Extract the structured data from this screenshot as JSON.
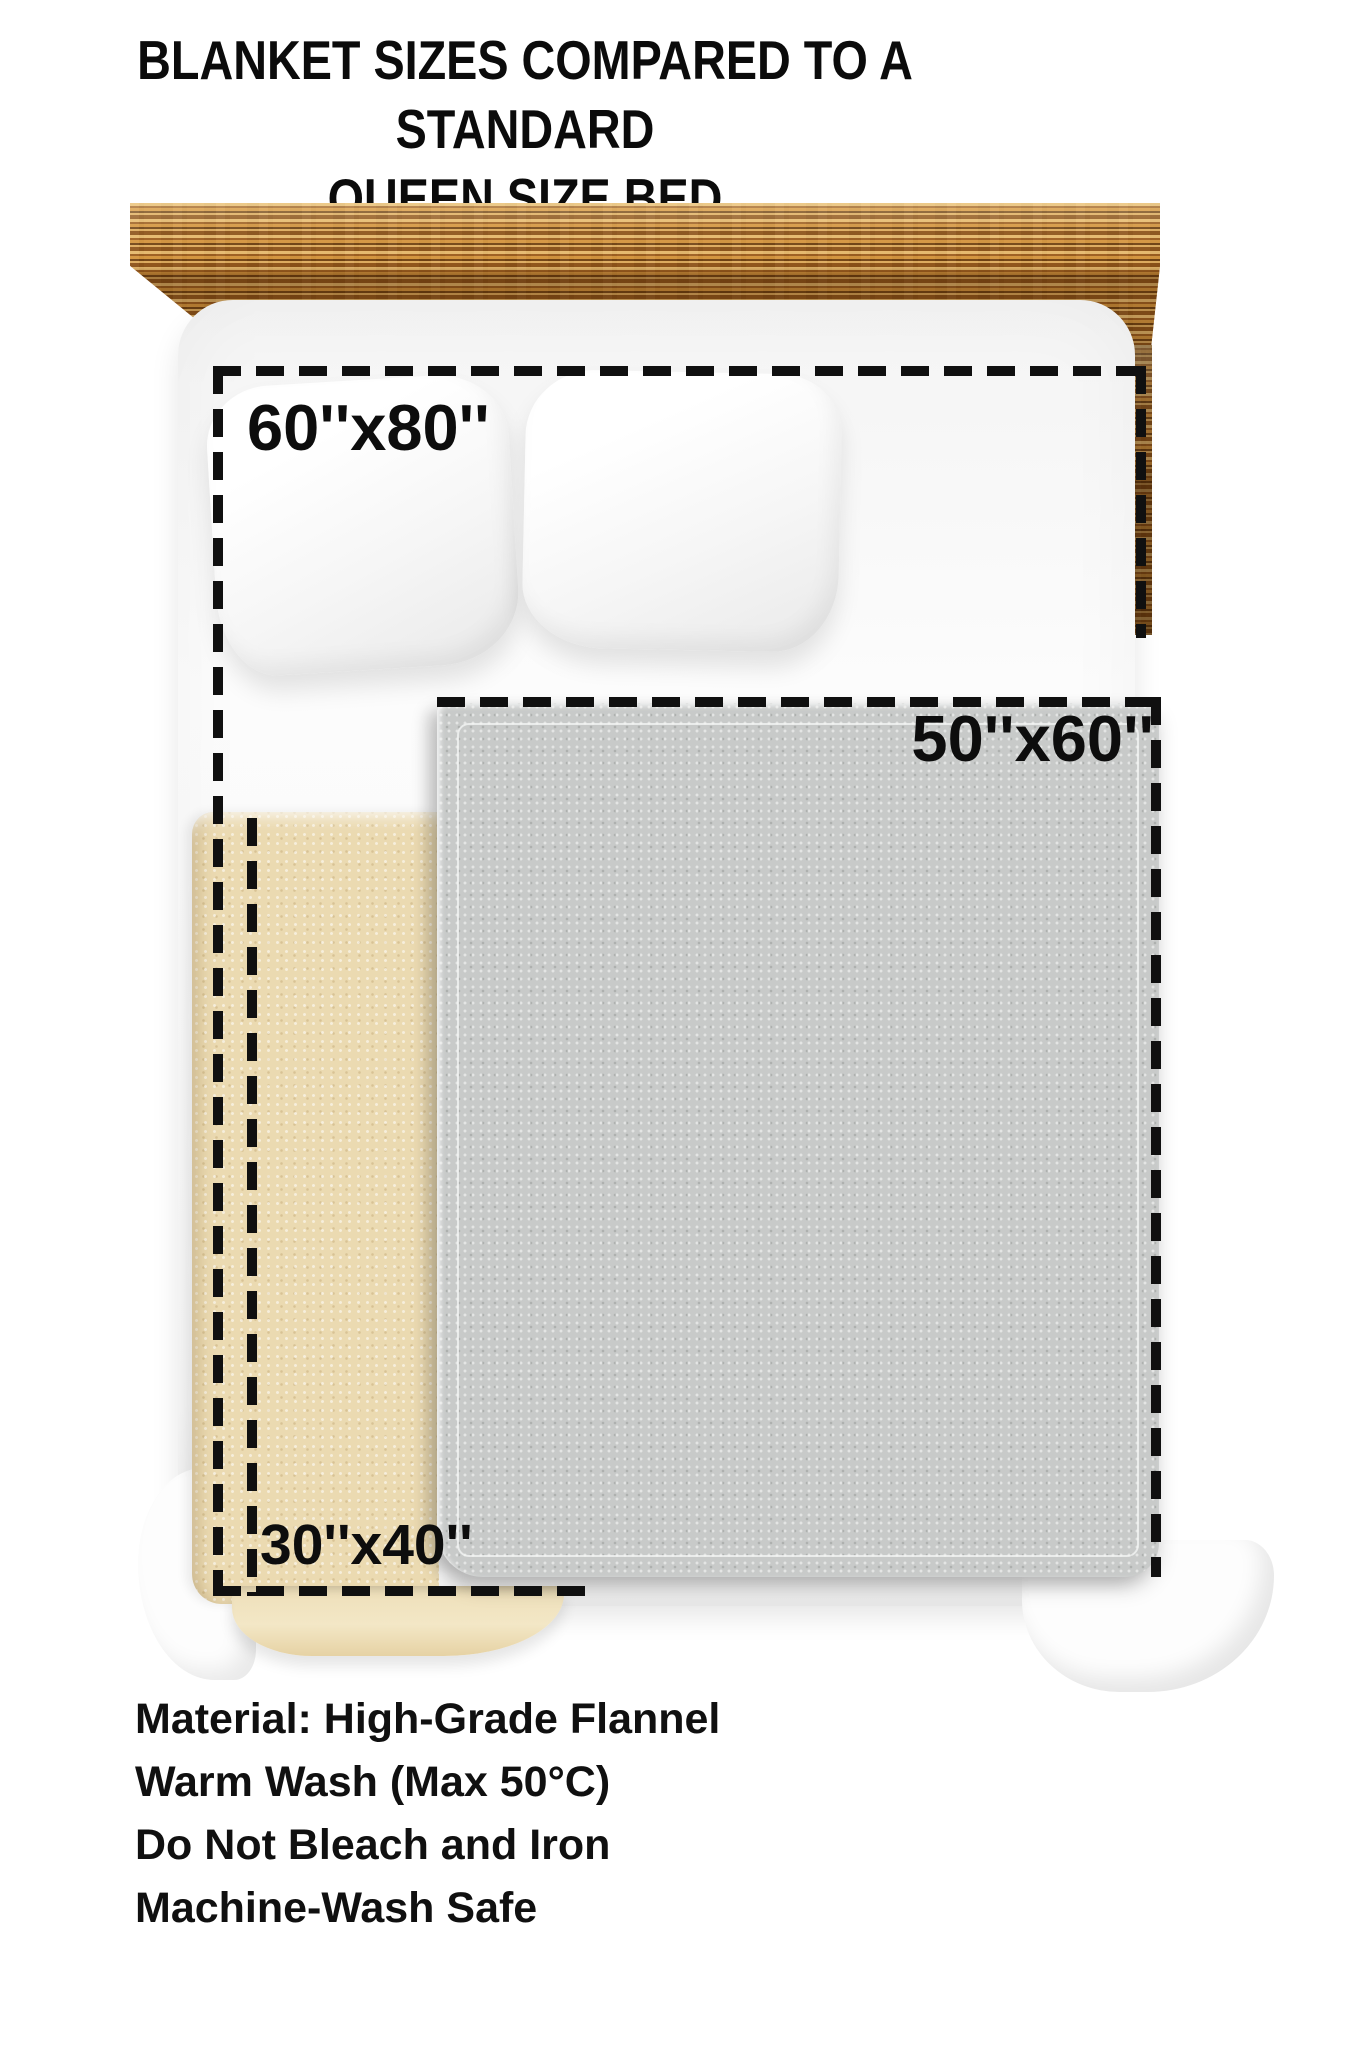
{
  "title": {
    "line1": "BLANKET SIZES COMPARED TO A STANDARD",
    "line2": "QUEEN SIZE BED"
  },
  "blankets": {
    "large": {
      "label": "60''x80''"
    },
    "medium": {
      "label": "50''x60''"
    },
    "small": {
      "label": "30''x40''"
    }
  },
  "care_lines": [
    "Material: High-Grade Flannel",
    "Warm Wash (Max 50°C)",
    "Do Not Bleach and Iron",
    "Machine-Wash Safe"
  ],
  "colors": {
    "background": "#ffffff",
    "dash_outline": "#101010",
    "wood_frame": "#ad6a22",
    "blanket_medium_gray": "#c8cac9",
    "blanket_small_beige": "#ebdab1",
    "text": "#0b0b0b"
  }
}
